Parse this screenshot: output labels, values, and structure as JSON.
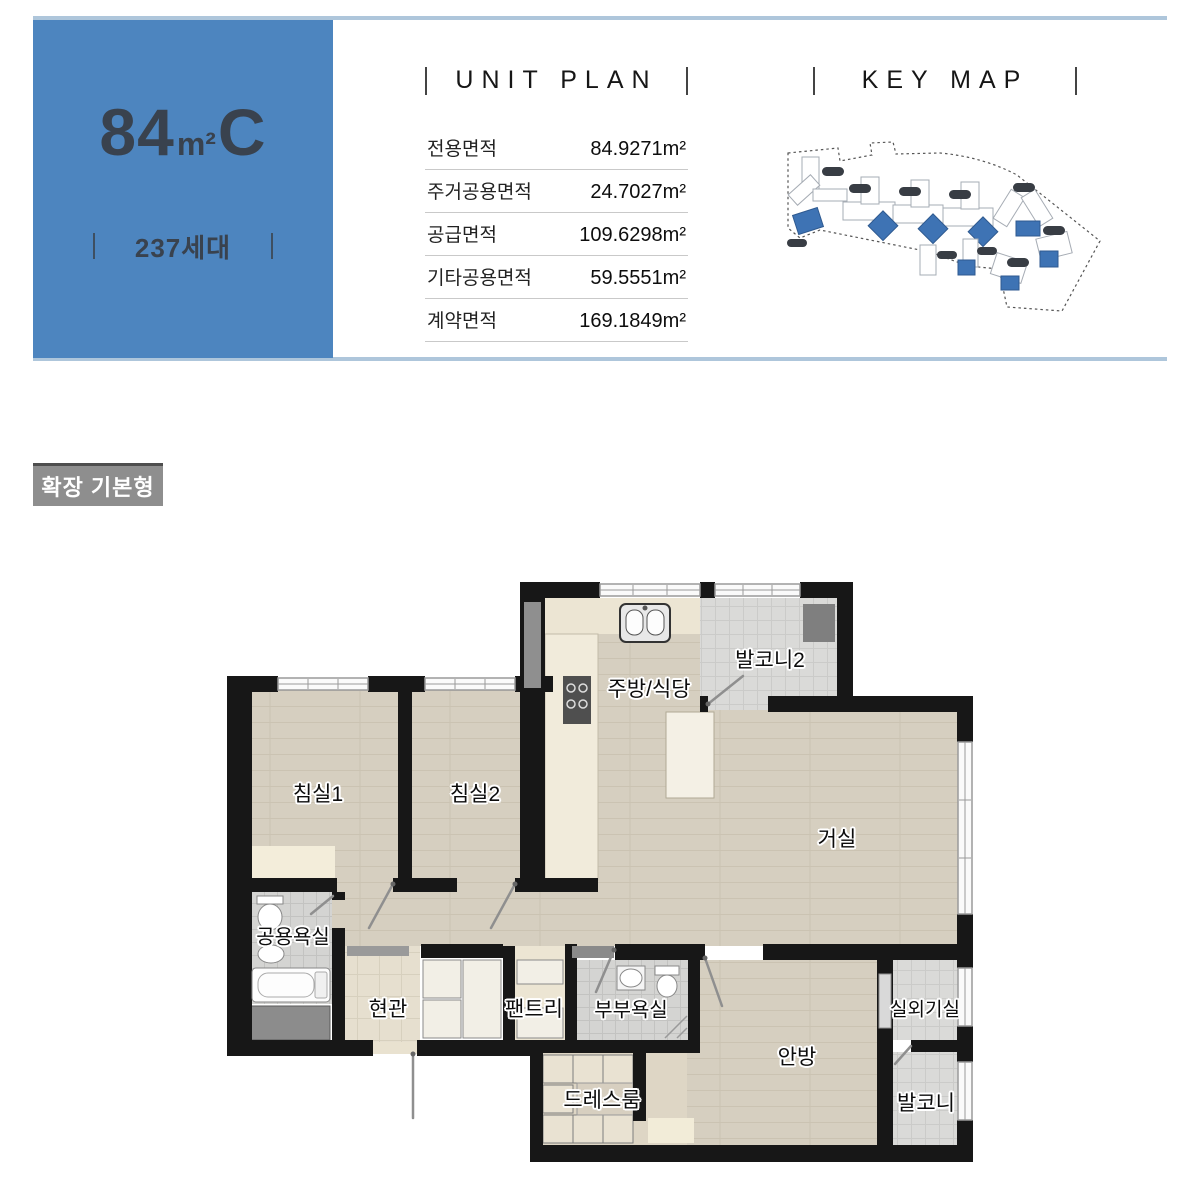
{
  "header": {
    "unit_code": {
      "number": "84",
      "unit": "m²",
      "suffix": "C"
    },
    "households": "237세대"
  },
  "unit_plan": {
    "title": "UNIT PLAN",
    "rows": [
      {
        "label": "전용면적",
        "value": "84.9271m²"
      },
      {
        "label": "주거공용면적",
        "value": "24.7027m²"
      },
      {
        "label": "공급면적",
        "value": "109.6298m²"
      },
      {
        "label": "기타공용면적",
        "value": "59.5551m²"
      },
      {
        "label": "계약면적",
        "value": "169.1849m²"
      }
    ]
  },
  "key_map": {
    "title": "KEY MAP"
  },
  "plan_badge": {
    "label": "확장 기본형"
  },
  "floorplan": {
    "rooms": [
      {
        "id": "bedroom1",
        "name": "침실1"
      },
      {
        "id": "bedroom2",
        "name": "침실2"
      },
      {
        "id": "kitchen",
        "name": "주방/식당"
      },
      {
        "id": "balcony2",
        "name": "발코니2"
      },
      {
        "id": "living",
        "name": "거실"
      },
      {
        "id": "common-bath",
        "name": "공용욕실"
      },
      {
        "id": "entrance",
        "name": "현관"
      },
      {
        "id": "pantry",
        "name": "팬트리"
      },
      {
        "id": "master-bath",
        "name": "부부욕실"
      },
      {
        "id": "dressroom",
        "name": "드레스룸"
      },
      {
        "id": "master-bedroom",
        "name": "안방"
      },
      {
        "id": "ac-room",
        "name": "실외기실"
      },
      {
        "id": "balcony",
        "name": "발코니"
      }
    ]
  },
  "colors": {
    "accent_blue": "#4d85bf",
    "rule_blue": "#aec6db",
    "badge_gray": "#8e8e8e",
    "wall_black": "#171717",
    "wood_floor": "#d6cfc0",
    "kitchen_cream": "#ece5d3",
    "tile_gray": "#d4d4d2",
    "map_highlight_blue": "#3e73b4"
  }
}
